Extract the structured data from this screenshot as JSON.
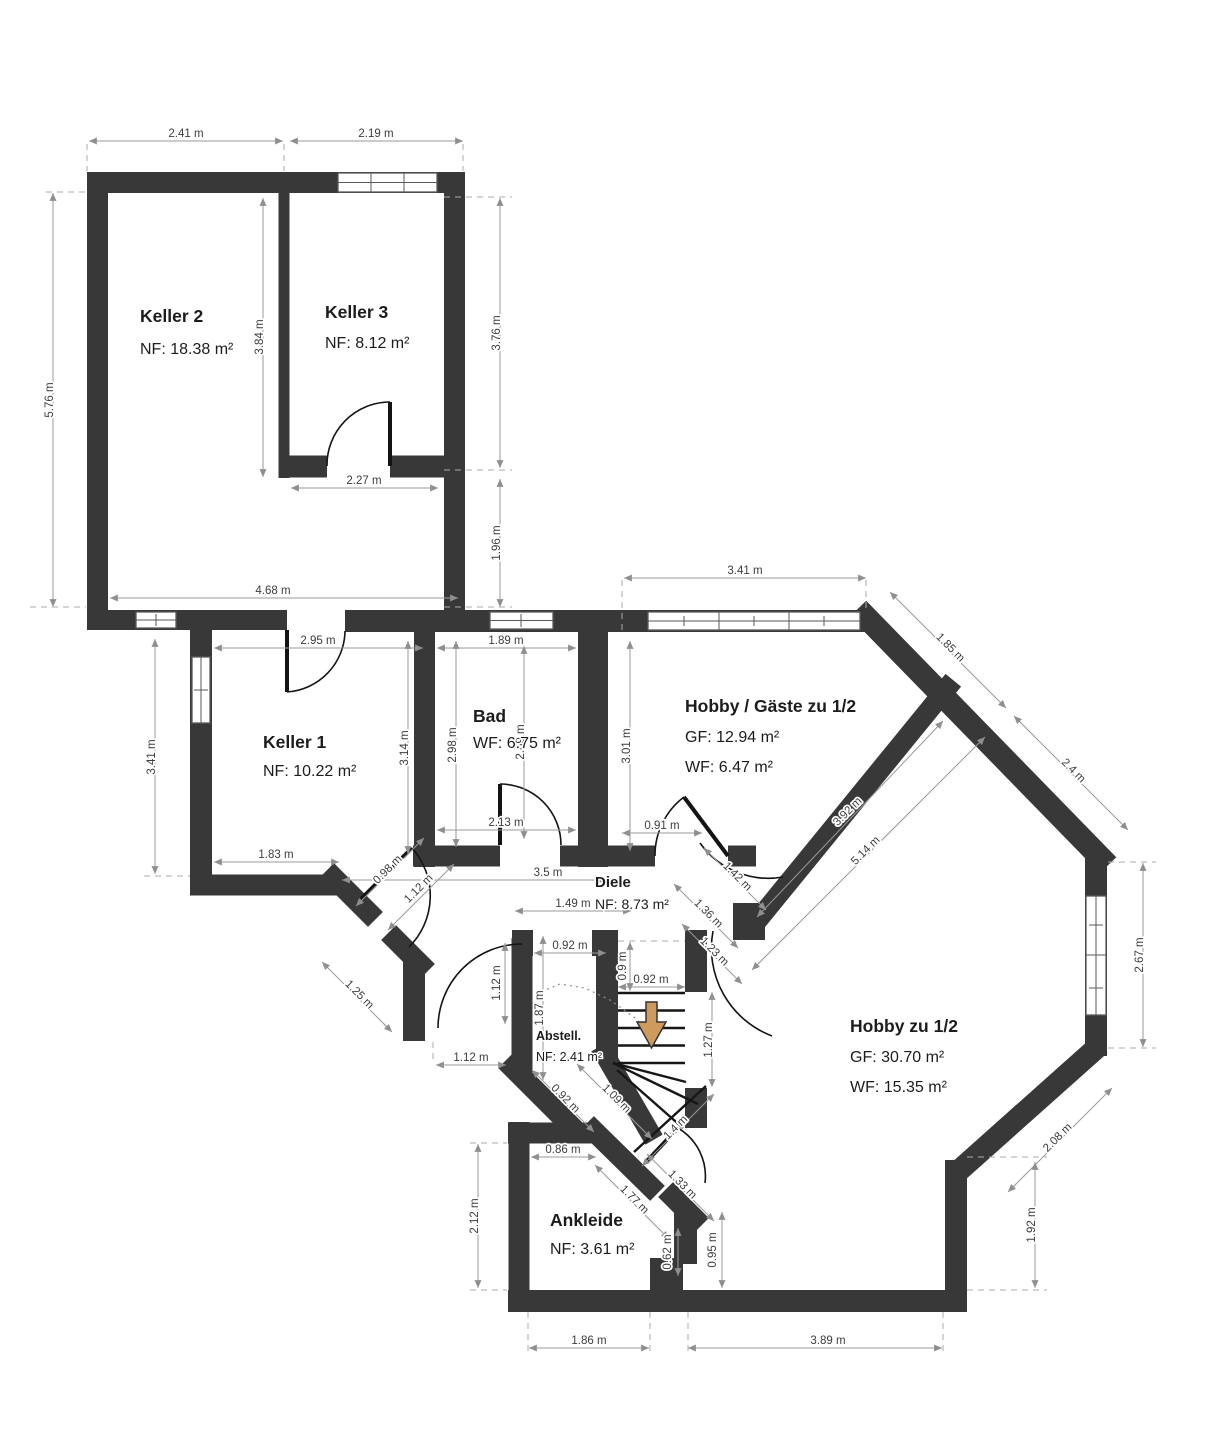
{
  "plan": {
    "colors": {
      "wall": "#383838",
      "dimension_line": "#9a9a9a",
      "dimension_text": "#3d3d3d",
      "stairs_arrow": "#cf9a5e"
    },
    "stairs": {
      "arrow_icon": "down-arrow"
    },
    "rooms": [
      {
        "id": "keller2",
        "name": "Keller 2",
        "lines": [
          "NF: 18.38 m²"
        ],
        "x": 140,
        "y": 322,
        "gap": 32
      },
      {
        "id": "keller3",
        "name": "Keller 3",
        "lines": [
          "NF: 8.12 m²"
        ],
        "x": 325,
        "y": 318,
        "gap": 30
      },
      {
        "id": "keller1",
        "name": "Keller 1",
        "lines": [
          "NF: 10.22 m²"
        ],
        "x": 263,
        "y": 748,
        "gap": 28
      },
      {
        "id": "bad",
        "name": "Bad",
        "lines": [
          "WF: 6.75 m²"
        ],
        "x": 473,
        "y": 722,
        "gap": 26
      },
      {
        "id": "hobby-gaeste",
        "name": "Hobby / Gäste zu 1/2",
        "lines": [
          "GF: 12.94 m²",
          "WF: 6.47 m²"
        ],
        "x": 685,
        "y": 712,
        "gap": 30
      },
      {
        "id": "diele",
        "name": "Diele",
        "lines": [
          "NF: 8.73 m²"
        ],
        "x": 595,
        "y": 887,
        "gap": 22,
        "name_size": 15,
        "sub_size": 14
      },
      {
        "id": "abstell",
        "name": "Abstell.",
        "lines": [
          "NF: 2.41 m²"
        ],
        "x": 536,
        "y": 1040,
        "gap": 21,
        "name_size": 12.5,
        "sub_size": 12.5
      },
      {
        "id": "hobby",
        "name": "Hobby zu 1/2",
        "lines": [
          "GF: 30.70 m²",
          "WF: 15.35 m²"
        ],
        "x": 850,
        "y": 1032,
        "gap": 30
      },
      {
        "id": "ankleide",
        "name": "Ankleide",
        "lines": [
          "NF: 3.61 m²"
        ],
        "x": 550,
        "y": 1226,
        "gap": 28
      }
    ],
    "dimensions": [
      {
        "label": "2.41 m",
        "x": 186,
        "y": 137,
        "r": 0
      },
      {
        "label": "2.19 m",
        "x": 376,
        "y": 137,
        "r": 0
      },
      {
        "label": "5.76 m",
        "x": 53,
        "y": 400,
        "r": -90
      },
      {
        "label": "3.84 m",
        "x": 263,
        "y": 337,
        "r": -90
      },
      {
        "label": "3.76 m",
        "x": 500,
        "y": 333,
        "r": -90
      },
      {
        "label": "2.27 m",
        "x": 364,
        "y": 484,
        "r": 0
      },
      {
        "label": "1.96 m",
        "x": 500,
        "y": 543,
        "r": -90
      },
      {
        "label": "4.68 m",
        "x": 273,
        "y": 594,
        "r": 0
      },
      {
        "label": "2.95 m",
        "x": 318,
        "y": 644,
        "r": 0
      },
      {
        "label": "1.89 m",
        "x": 506,
        "y": 644,
        "r": 0
      },
      {
        "label": "3.41 m",
        "x": 745,
        "y": 574,
        "r": 0
      },
      {
        "label": "3.41 m",
        "x": 155,
        "y": 757,
        "r": -90
      },
      {
        "label": "3.14 m",
        "x": 408,
        "y": 748,
        "r": -90
      },
      {
        "label": "2.98 m",
        "x": 456,
        "y": 745,
        "r": -90
      },
      {
        "label": "2.69 m",
        "x": 524,
        "y": 742,
        "r": -90
      },
      {
        "label": "3.01 m",
        "x": 630,
        "y": 746,
        "r": -90
      },
      {
        "label": "1.83 m",
        "x": 276,
        "y": 858,
        "r": 0
      },
      {
        "label": "2.13 m",
        "x": 506,
        "y": 826,
        "r": 0
      },
      {
        "label": "0.91 m",
        "x": 662,
        "y": 829,
        "r": 0
      },
      {
        "label": "3.5 m",
        "x": 548,
        "y": 876,
        "r": 0
      },
      {
        "label": "0.98 m",
        "x": 390,
        "y": 872,
        "r": -45
      },
      {
        "label": "1.12 m",
        "x": 421,
        "y": 891,
        "r": -45
      },
      {
        "label": "1.25 m",
        "x": 357,
        "y": 997,
        "r": 45
      },
      {
        "label": "1.42 m",
        "x": 735,
        "y": 879,
        "r": 45
      },
      {
        "label": "1.36 m",
        "x": 706,
        "y": 916,
        "r": 45
      },
      {
        "label": "1.23 m",
        "x": 712,
        "y": 954,
        "r": 45
      },
      {
        "label": "3.92 m",
        "x": 850,
        "y": 814,
        "r": -45
      },
      {
        "label": "5.14 m",
        "x": 868,
        "y": 853,
        "r": -45
      },
      {
        "label": "1.85 m",
        "x": 948,
        "y": 650,
        "r": 45
      },
      {
        "label": "2.4 m",
        "x": 1071,
        "y": 773,
        "r": 45
      },
      {
        "label": "2.67 m",
        "x": 1143,
        "y": 955,
        "r": -90
      },
      {
        "label": "2.08 m",
        "x": 1060,
        "y": 1140,
        "r": -45
      },
      {
        "label": "1.49 m",
        "x": 573,
        "y": 907,
        "r": 0
      },
      {
        "label": "0.92 m",
        "x": 570,
        "y": 949,
        "r": 0
      },
      {
        "label": "0.9 m",
        "x": 626,
        "y": 966,
        "r": -90
      },
      {
        "label": "0.92 m",
        "x": 651,
        "y": 983,
        "r": 0
      },
      {
        "label": "1.87 m",
        "x": 543,
        "y": 1008,
        "r": -90
      },
      {
        "label": "1.12 m",
        "x": 500,
        "y": 983,
        "r": -90
      },
      {
        "label": "1.27 m",
        "x": 712,
        "y": 1040,
        "r": -90
      },
      {
        "label": "1.12 m",
        "x": 471,
        "y": 1061,
        "r": 0
      },
      {
        "label": "0.92 m",
        "x": 563,
        "y": 1101,
        "r": 45
      },
      {
        "label": "1.09 m",
        "x": 614,
        "y": 1101,
        "r": 45
      },
      {
        "label": "0.86 m",
        "x": 563,
        "y": 1153,
        "r": 0
      },
      {
        "label": "1.4 m",
        "x": 678,
        "y": 1130,
        "r": -45
      },
      {
        "label": "1.33 m",
        "x": 680,
        "y": 1187,
        "r": 45
      },
      {
        "label": "1.77 m",
        "x": 632,
        "y": 1202,
        "r": 45
      },
      {
        "label": "2.12 m",
        "x": 478,
        "y": 1216,
        "r": -90
      },
      {
        "label": "0.62 m",
        "x": 671,
        "y": 1252,
        "r": -90
      },
      {
        "label": "0.95 m",
        "x": 716,
        "y": 1250,
        "r": -90
      },
      {
        "label": "1.92 m",
        "x": 1035,
        "y": 1225,
        "r": -90
      },
      {
        "label": "1.86 m",
        "x": 589,
        "y": 1344,
        "r": 0
      },
      {
        "label": "3.89 m",
        "x": 828,
        "y": 1344,
        "r": 0
      }
    ]
  }
}
